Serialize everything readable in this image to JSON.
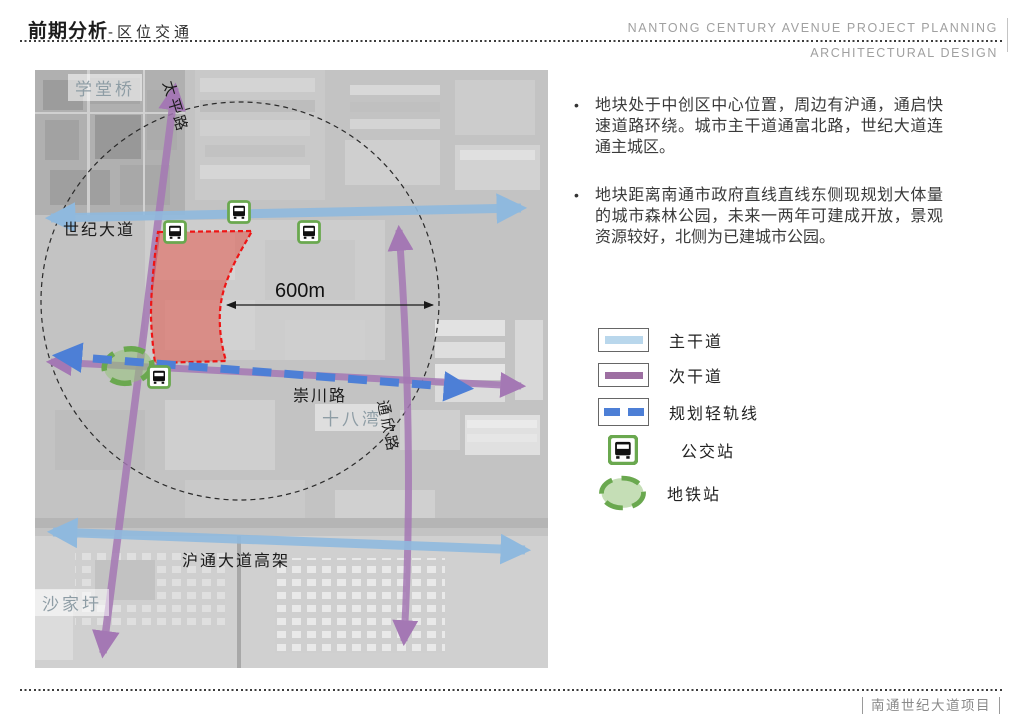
{
  "header": {
    "title_bold": "前期分析",
    "title_rest": "-区位交通",
    "right_line1": "NANTONG  CENTURY  AVENUE  PROJECT  PLANNING",
    "right_line2": "ARCHITECTURAL  DESIGN"
  },
  "map": {
    "labels": {
      "xuetangqiao": "学堂桥",
      "taiping_road": "太平路",
      "shiji_avenue": "世纪大道",
      "distance": "600m",
      "chongchuan_road": "崇川路",
      "shibawan": "十八湾",
      "tongxin_road": "通欣路",
      "hutong_elevated": "沪通大道高架",
      "shajiayu": "沙家圩"
    }
  },
  "notes": [
    "地块处于中创区中心位置，周边有沪通，通启快速道路环绕。城市主干道通富北路，世纪大道连通主城区。",
    "地块距离南通市政府直线直线东侧现规划大体量的城市森林公园，未来一两年可建成开放，景观资源较好，北侧为已建城市公园。"
  ],
  "legend": {
    "items": [
      {
        "label": "主干道"
      },
      {
        "label": "次干道"
      },
      {
        "label": "规划轻轨线"
      },
      {
        "label": "公交站"
      },
      {
        "label": "地铁站"
      }
    ]
  },
  "footer": {
    "project": "南通世纪大道项目"
  },
  "colors": {
    "main_road": "#8fb9de",
    "secondary_road": "#a478b4",
    "planned_rail": "#4d7fd6",
    "station_green": "#6aa84f",
    "site_red": "#e0483c"
  },
  "annotations": {
    "bullet": "•"
  }
}
